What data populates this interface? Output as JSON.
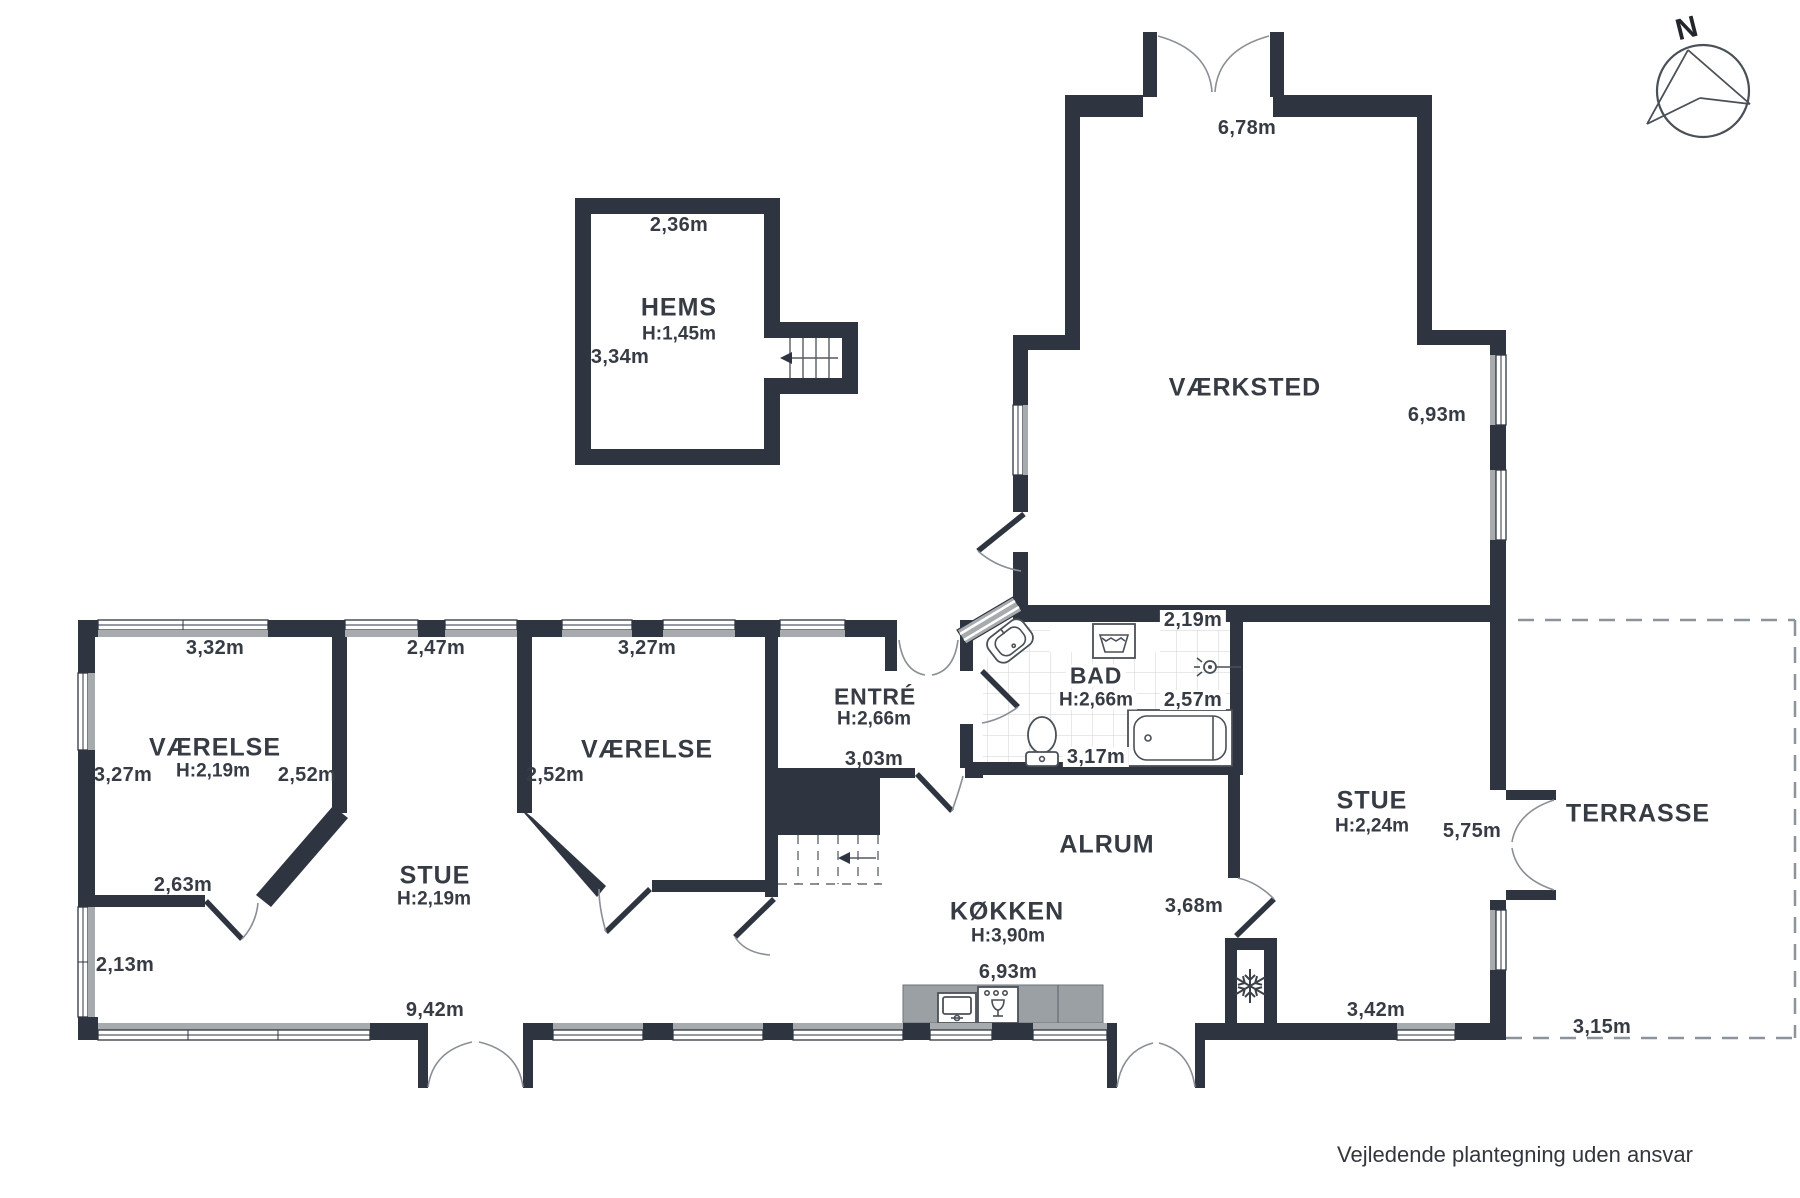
{
  "meta": {
    "disclaimer": "Vejledende plantegning uden ansvar",
    "compass_label": "N"
  },
  "colors": {
    "wall": "#2f3540",
    "window_band": "#a7abae",
    "counter": "#9ba0a4",
    "text": "#363b44"
  },
  "rooms": {
    "hems": {
      "name": "HEMS",
      "ceiling_height": "H:1,45m",
      "width_top": "2,36m",
      "height_left": "3,34m"
    },
    "vaerksted": {
      "name": "VÆRKSTED",
      "width_top": "6,78m",
      "height_right": "6,93m"
    },
    "vaerelse_left": {
      "name": "VÆRELSE",
      "ceiling_height": "H:2,19m",
      "width_top": "3,32m",
      "height_left": "3,27m",
      "height_right": "2,52m",
      "width_bottom": "2,63m"
    },
    "stue_left": {
      "name": "STUE",
      "ceiling_height": "H:2,19m",
      "width_top": "2,47m",
      "height_left": "2,13m",
      "width_bottom": "9,42m"
    },
    "vaerelse_mid": {
      "name": "VÆRELSE",
      "width_top": "3,27m",
      "height_left": "2,52m"
    },
    "entre": {
      "name": "ENTRÉ",
      "ceiling_height": "H:2,66m",
      "width_bottom": "3,03m"
    },
    "bad": {
      "name": "BAD",
      "ceiling_height": "H:2,66m",
      "width_top": "2,19m",
      "height_right": "2,57m",
      "width_bottom": "3,17m"
    },
    "alrum": {
      "name": "ALRUM"
    },
    "koekken": {
      "name": "KØKKEN",
      "ceiling_height": "H:3,90m",
      "width_bottom": "6,93m",
      "height_right": "3,68m"
    },
    "stue_right": {
      "name": "STUE",
      "ceiling_height": "H:2,24m",
      "height_right": "5,75m",
      "width_bottom": "3,42m"
    },
    "terrasse": {
      "name": "TERRASSE",
      "width_bottom": "3,15m"
    }
  }
}
